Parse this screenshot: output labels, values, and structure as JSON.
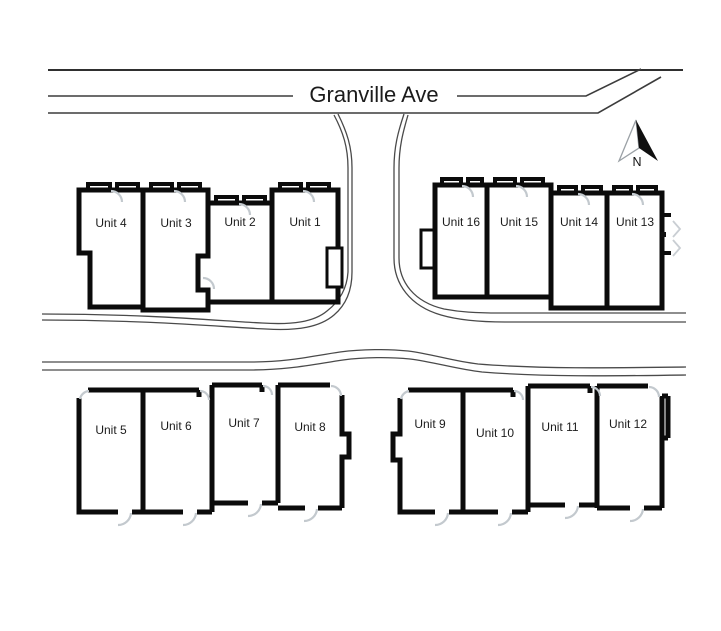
{
  "street": {
    "name": "Granville Ave"
  },
  "compass": {
    "label": "N"
  },
  "colors": {
    "background": "#ffffff",
    "wall": "#0b0b0b",
    "road_line": "#3c3c3c",
    "door_swing": "#c3c9ce",
    "label_text": "#1c1c1c"
  },
  "blocks": [
    {
      "name": "north-west-rowhouse",
      "units": [
        {
          "label": "Unit 4"
        },
        {
          "label": "Unit 3"
        },
        {
          "label": "Unit 2"
        },
        {
          "label": "Unit 1"
        }
      ]
    },
    {
      "name": "north-east-rowhouse",
      "units": [
        {
          "label": "Unit 16"
        },
        {
          "label": "Unit 15"
        },
        {
          "label": "Unit 14"
        },
        {
          "label": "Unit 13"
        }
      ]
    },
    {
      "name": "south-west-rowhouse",
      "units": [
        {
          "label": "Unit 5"
        },
        {
          "label": "Unit 6"
        },
        {
          "label": "Unit 7"
        },
        {
          "label": "Unit 8"
        }
      ]
    },
    {
      "name": "south-east-rowhouse",
      "units": [
        {
          "label": "Unit 9"
        },
        {
          "label": "Unit 10"
        },
        {
          "label": "Unit 11"
        },
        {
          "label": "Unit 12"
        }
      ]
    }
  ]
}
